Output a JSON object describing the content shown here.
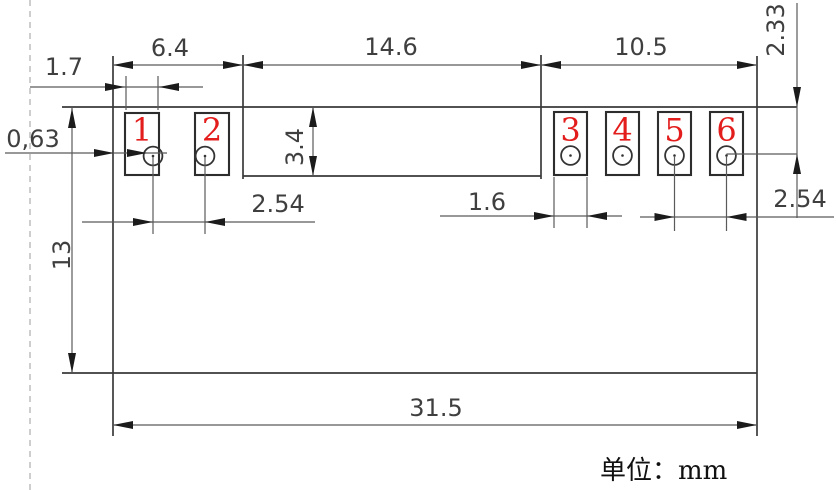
{
  "drawing": {
    "unit_note": "单位：mm",
    "colors": {
      "pad_number_red": "#e31c1c",
      "outline": "#3a3a3a",
      "dimension": "#5a5a5a",
      "margin_dash": "#aeaeae"
    },
    "dimensions": {
      "pads12_span": "6.4",
      "middle_span": "14.6",
      "pads36_span": "10.5",
      "pad1_width": "1.7",
      "edge_offset": "0,63",
      "middle_block_height": "3.4",
      "pitch_left": "2.54",
      "pad3_width": "1.6",
      "pitch_right": "2.54",
      "top_to_hole": "2.33",
      "board_height": "13",
      "board_width": "31.5"
    },
    "pad_labels": [
      "1",
      "2",
      "3",
      "4",
      "5",
      "6"
    ]
  }
}
